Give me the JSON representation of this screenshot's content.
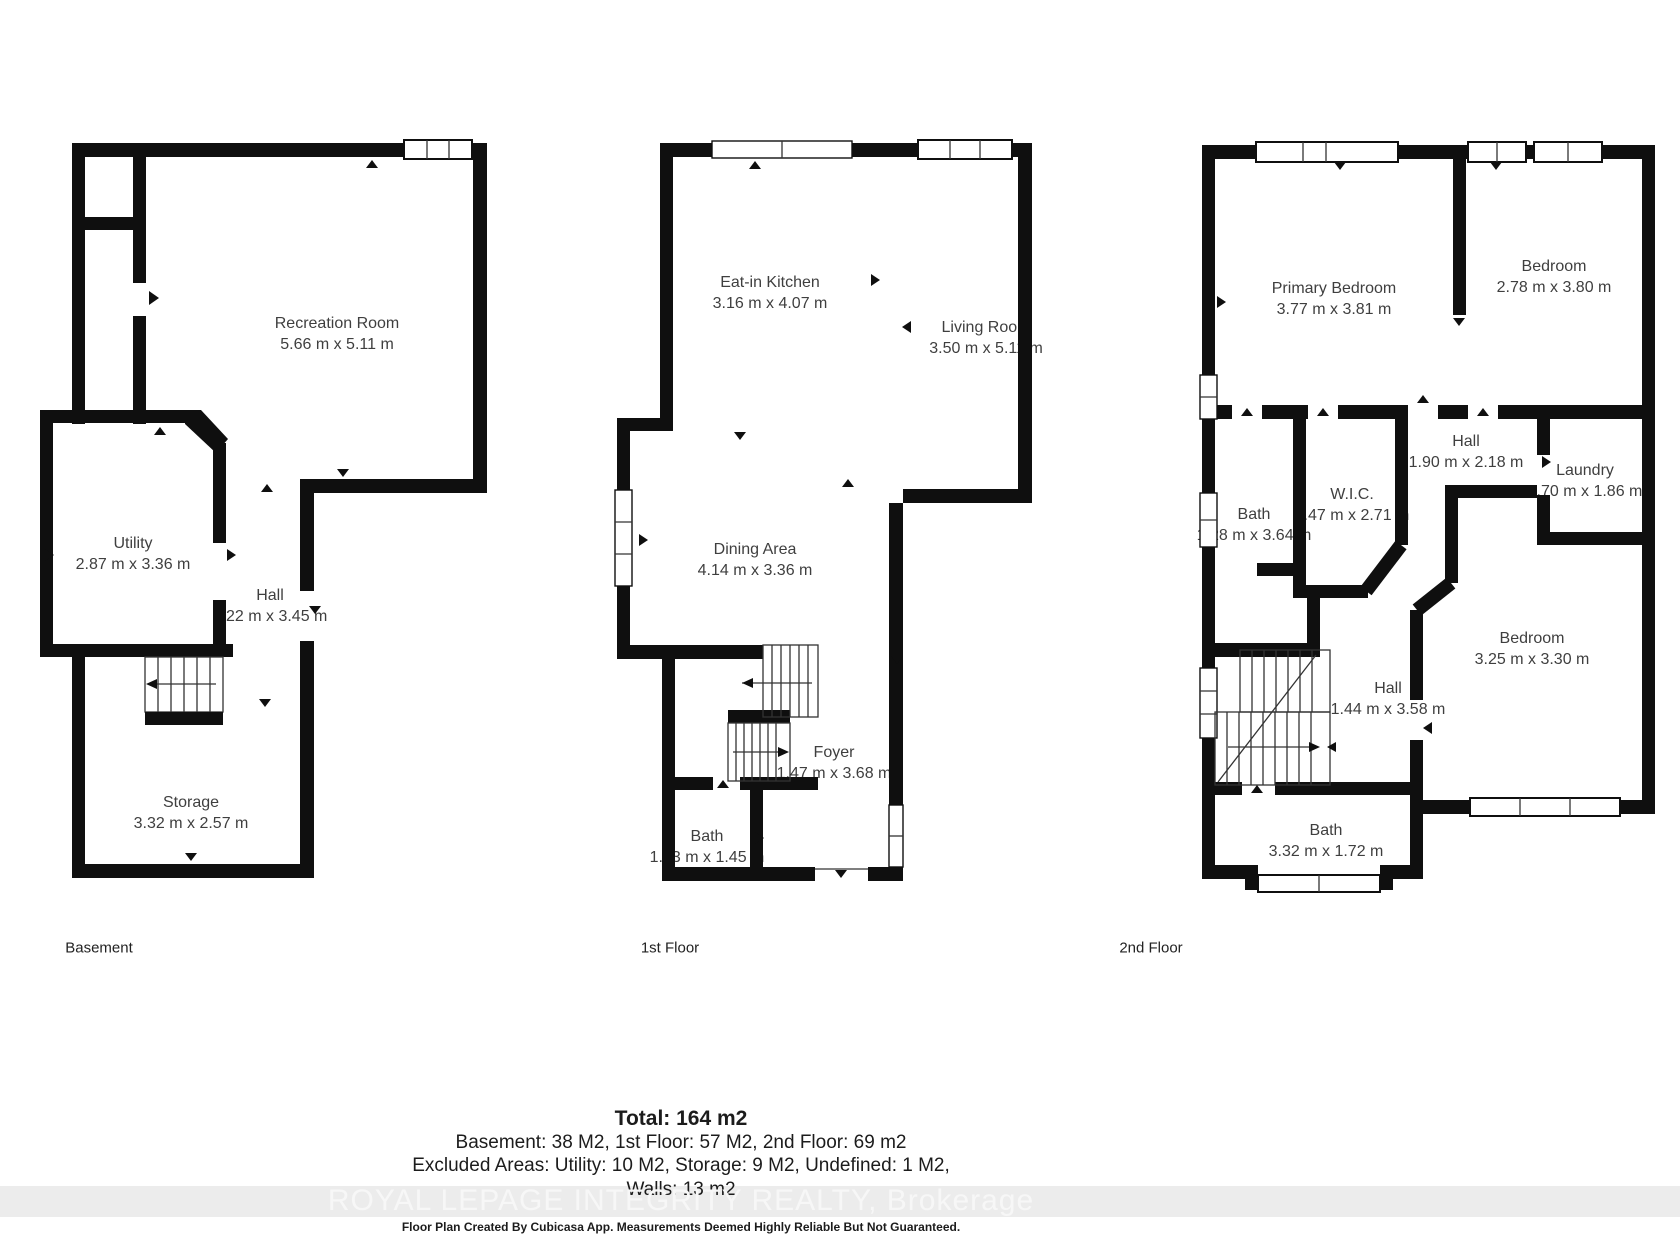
{
  "colors": {
    "wall": "#0f0f0f",
    "background": "#ffffff",
    "label_text": "#3f3f3f",
    "watermark_band": "#ececec",
    "watermark_text": "#f7f7f7"
  },
  "floors": [
    {
      "label": "Basement",
      "rooms": [
        {
          "name": "Recreation Room",
          "dims": "5.66 m x 5.11 m"
        },
        {
          "name": "Utility",
          "dims": "2.87 m x 3.36 m"
        },
        {
          "name": "Hall",
          "dims": "1.22 m x 3.45 m"
        },
        {
          "name": "Storage",
          "dims": "3.32 m x 2.57 m"
        }
      ]
    },
    {
      "label": "1st Floor",
      "rooms": [
        {
          "name": "Eat-in Kitchen",
          "dims": "3.16 m x 4.07 m"
        },
        {
          "name": "Living Room",
          "dims": "3.50 m x 5.11 m"
        },
        {
          "name": "Dining Area",
          "dims": "4.14 m x 3.36 m"
        },
        {
          "name": "Foyer",
          "dims": "1.47 m x 3.68 m"
        },
        {
          "name": "Bath",
          "dims": "1.53 m x 1.45 m"
        }
      ]
    },
    {
      "label": "2nd Floor",
      "rooms": [
        {
          "name": "Primary Bedroom",
          "dims": "3.77 m x 3.81 m"
        },
        {
          "name": "Bedroom",
          "dims": "2.78 m x 3.80 m"
        },
        {
          "name": "Hall",
          "dims": "1.90 m x 2.18 m"
        },
        {
          "name": "Laundry",
          "dims": "1.70 m x 1.86 m"
        },
        {
          "name": "W.I.C.",
          "dims": "1.47 m x 2.71 m"
        },
        {
          "name": "Bath",
          "dims": "1.28 m x 3.64 m"
        },
        {
          "name": "Bedroom",
          "dims": "3.25 m x 3.30 m"
        },
        {
          "name": "Hall",
          "dims": "1.44 m x 3.58 m"
        },
        {
          "name": "Bath",
          "dims": "3.32 m x 1.72 m"
        }
      ]
    }
  ],
  "summary": {
    "total": "Total: 164 m2",
    "floors_line": "Basement: 38 M2, 1st Floor: 57 M2, 2nd Floor: 69 m2",
    "excluded_line": "Excluded Areas: Utility: 10 M2, Storage: 9 M2, Undefined: 1 M2,",
    "walls_line": "Walls: 13 m2"
  },
  "watermark": "ROYAL LEPAGE INTEGRITY REALTY, Brokerage",
  "disclaimer": "Floor Plan Created By Cubicasa App. Measurements Deemed Highly Reliable But Not Guaranteed."
}
